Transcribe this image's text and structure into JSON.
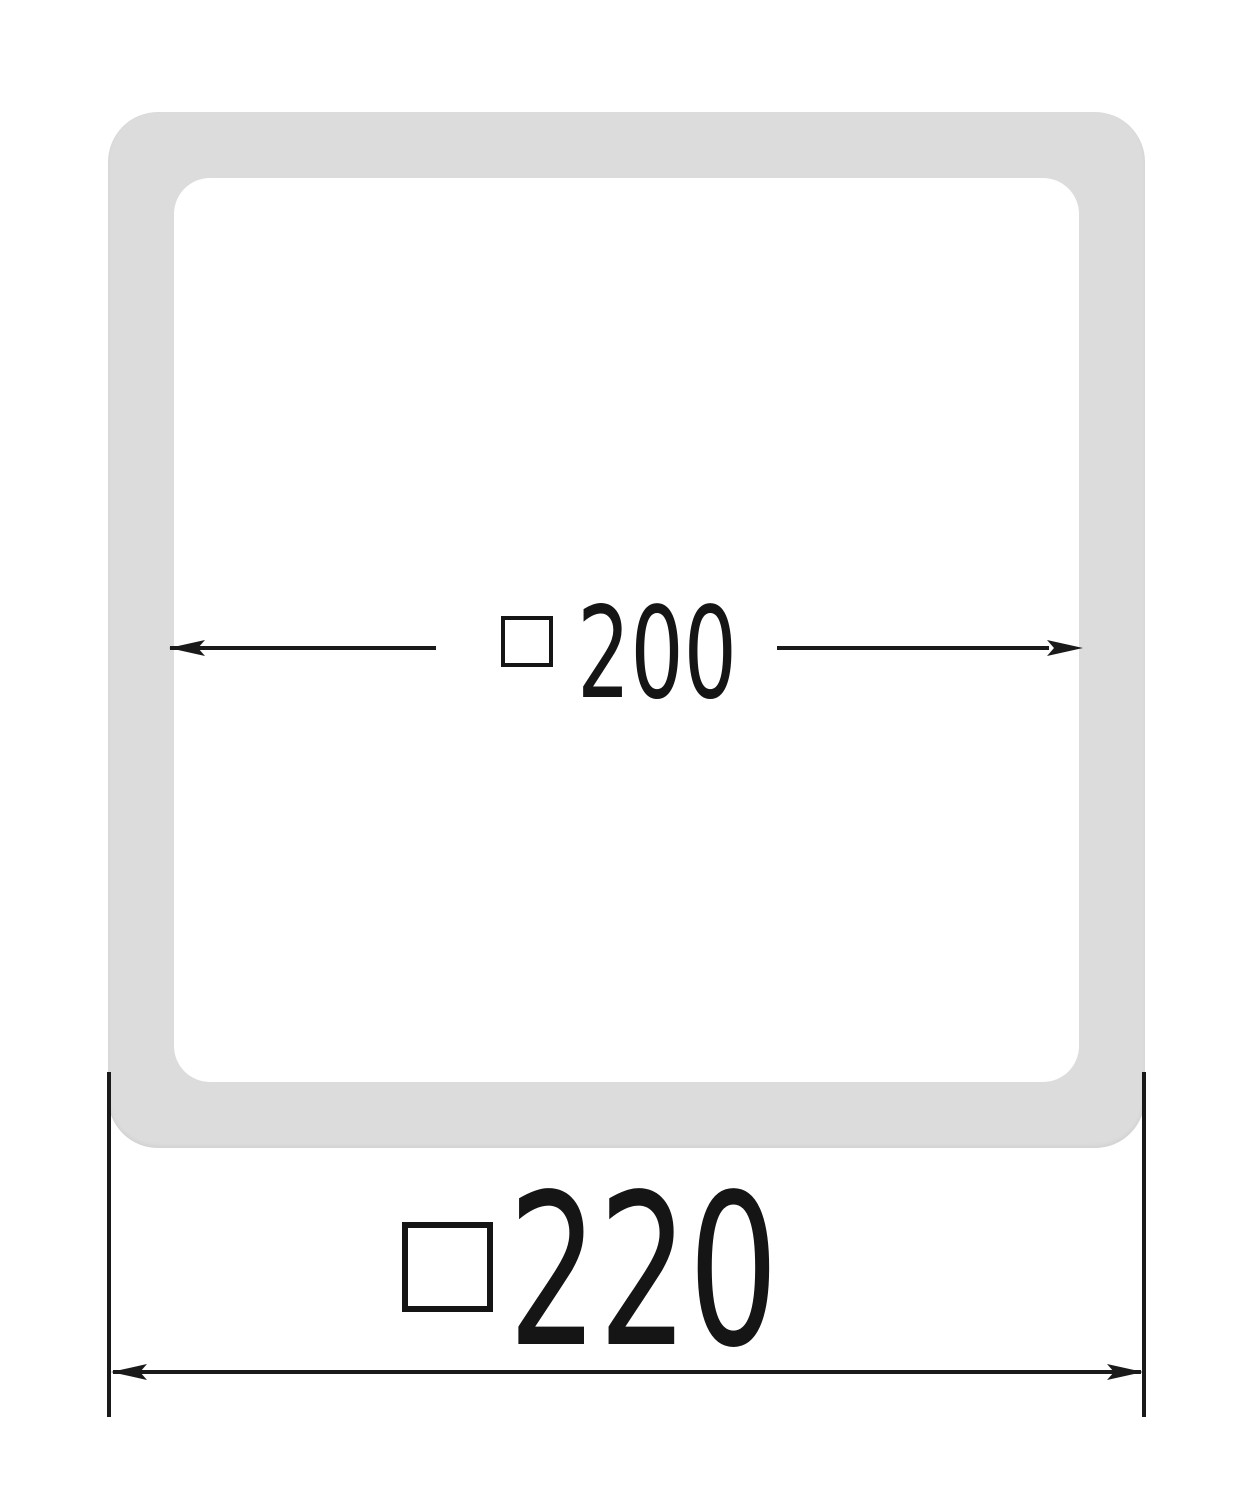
{
  "drawing": {
    "object": "square frame profile cross-section",
    "colors": {
      "frame_fill": "#dcdcdc",
      "line": "#1a1a1a",
      "background": "#ffffff"
    },
    "inner_dimension": {
      "symbol": "□",
      "value": "200"
    },
    "outer_dimension": {
      "symbol": "□",
      "value": "220"
    }
  }
}
